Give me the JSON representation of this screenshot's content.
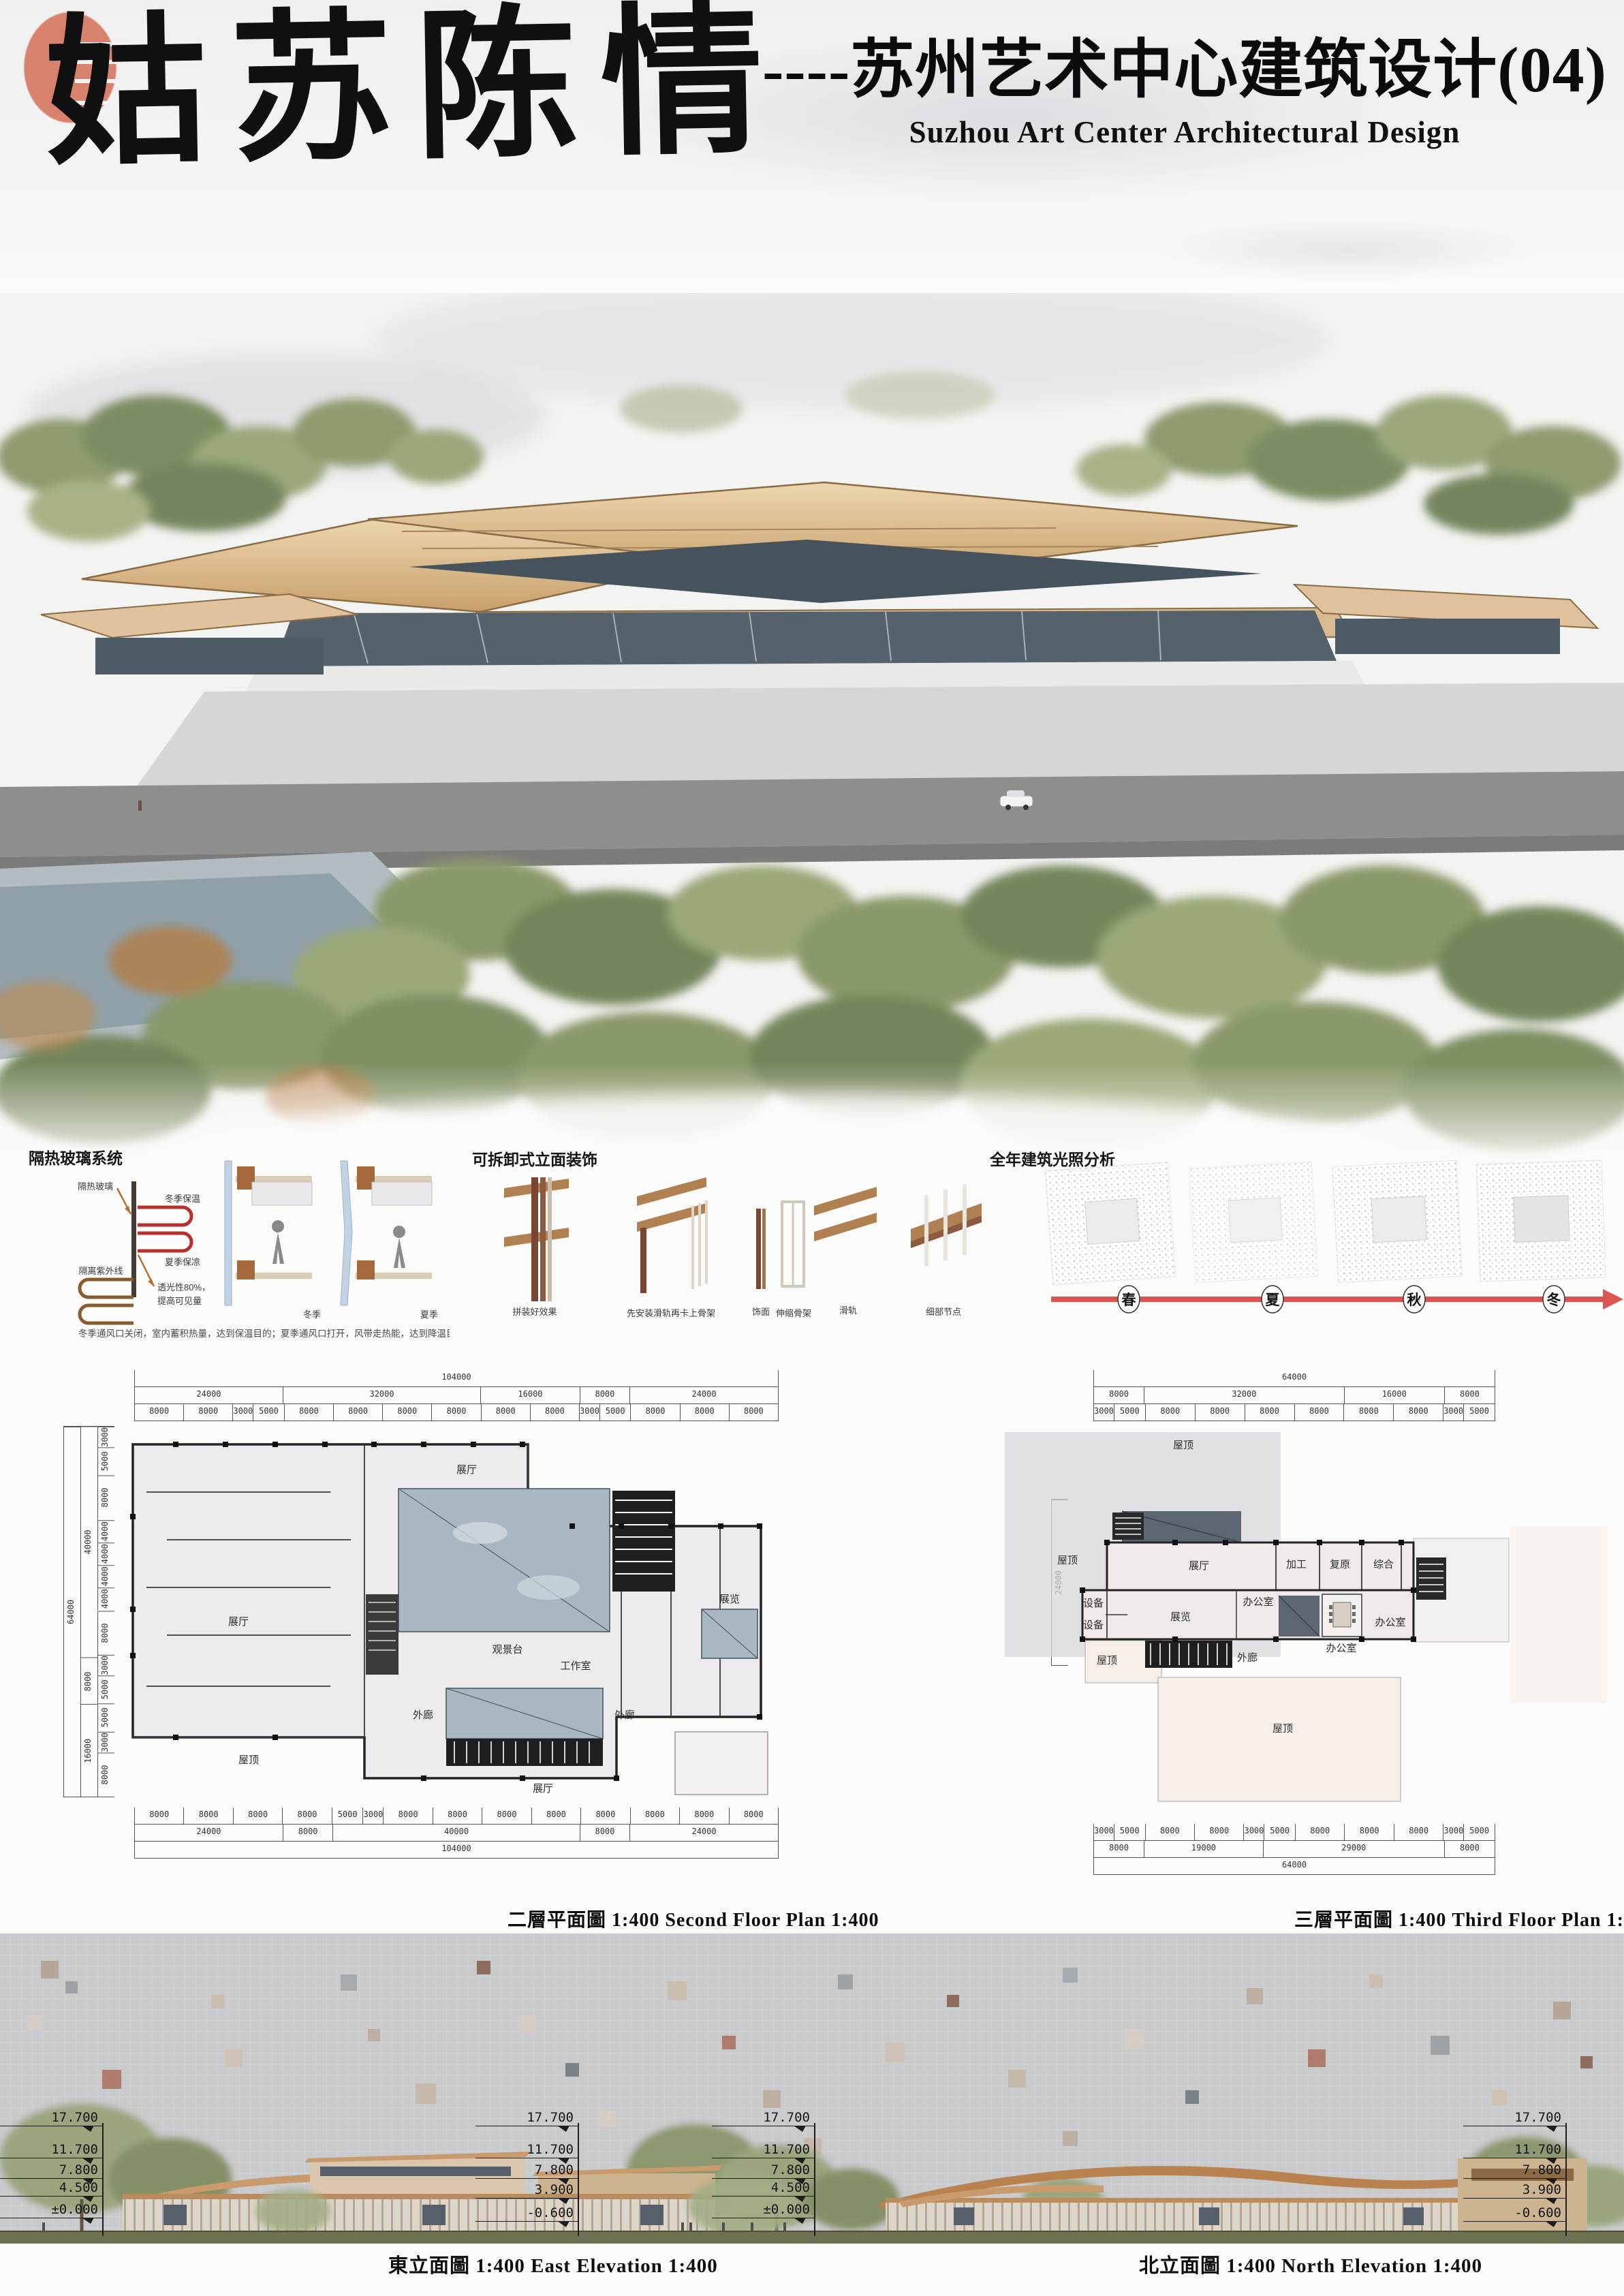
{
  "header": {
    "calligraphy_title": "姑苏陈情",
    "title_cn": "----苏州艺术中心建筑设计(04)",
    "title_en": "Suzhou Art Center Architectural Design"
  },
  "diagrams": {
    "glass": {
      "title": "隔热玻璃系统",
      "label_glass": "隔热玻璃",
      "label_winter_warm": "冬季保温",
      "label_uv": "隔离紫外线",
      "label_summer_cool": "夏季保凉",
      "label_translucency_1": "透光性80%，",
      "label_translucency_2": "提高可见量",
      "label_winter": "冬季",
      "label_summer": "夏季",
      "caption": "冬季通风口关闭，室内蓄积热量，达到保温目的；夏季通风口打开，风带走热能，达到降温目的"
    },
    "facade": {
      "title": "可拆卸式立面装饰",
      "labels": [
        "拼装好效果",
        "先安装滑轨再卡上骨架",
        "饰面",
        "伸缩骨架",
        "滑轨",
        "细部节点"
      ]
    },
    "sunlight": {
      "title": "全年建筑光照分析",
      "seasons": [
        "春",
        "夏",
        "秋",
        "冬"
      ],
      "arrow_color": "#dd5550"
    }
  },
  "plans": {
    "second": {
      "caption": "二層平面圖 1:400 Second  Floor Plan 1:400",
      "rooms": {
        "hall_top": "展厅",
        "hall_left": "展厅",
        "hall_bottom": "展厅",
        "deck": "观景台",
        "corridor_l": "外廊",
        "corridor_r": "外廊",
        "studio": "工作室",
        "exhibit": "展览",
        "roof": "屋顶"
      },
      "dims_top": {
        "total": [
          {
            "len": 104000,
            "label": "104000"
          }
        ],
        "groups": [
          {
            "len": 24000,
            "label": "24000"
          },
          {
            "len": 32000,
            "label": "32000"
          },
          {
            "len": 16000,
            "label": "16000"
          },
          {
            "len": 8000,
            "label": "8000"
          },
          {
            "len": 24000,
            "label": "24000"
          }
        ],
        "details": [
          {
            "len": 8000,
            "label": "8000"
          },
          {
            "len": 8000,
            "label": "8000"
          },
          {
            "len": 3000,
            "label": "3000"
          },
          {
            "len": 5000,
            "label": "5000"
          },
          {
            "len": 8000,
            "label": "8000"
          },
          {
            "len": 8000,
            "label": "8000"
          },
          {
            "len": 8000,
            "label": "8000"
          },
          {
            "len": 8000,
            "label": "8000"
          },
          {
            "len": 8000,
            "label": "8000"
          },
          {
            "len": 8000,
            "label": "8000"
          },
          {
            "len": 3000,
            "label": "3000"
          },
          {
            "len": 5000,
            "label": "5000"
          },
          {
            "len": 8000,
            "label": "8000"
          },
          {
            "len": 8000,
            "label": "8000"
          },
          {
            "len": 8000,
            "label": "8000"
          }
        ]
      },
      "dims_bottom": {
        "details": [
          {
            "len": 8000,
            "label": "8000"
          },
          {
            "len": 8000,
            "label": "8000"
          },
          {
            "len": 8000,
            "label": "8000"
          },
          {
            "len": 8000,
            "label": "8000"
          },
          {
            "len": 5000,
            "label": "5000"
          },
          {
            "len": 3000,
            "label": "3000"
          },
          {
            "len": 8000,
            "label": "8000"
          },
          {
            "len": 8000,
            "label": "8000"
          },
          {
            "len": 8000,
            "label": "8000"
          },
          {
            "len": 8000,
            "label": "8000"
          },
          {
            "len": 8000,
            "label": "8000"
          },
          {
            "len": 8000,
            "label": "8000"
          },
          {
            "len": 8000,
            "label": "8000"
          },
          {
            "len": 8000,
            "label": "8000"
          }
        ],
        "groups": [
          {
            "len": 24000,
            "label": "24000"
          },
          {
            "len": 8000,
            "label": "8000"
          },
          {
            "len": 40000,
            "label": "40000"
          },
          {
            "len": 8000,
            "label": "8000"
          },
          {
            "len": 24000,
            "label": "24000"
          }
        ],
        "total": [
          {
            "len": 104000,
            "label": "104000"
          }
        ]
      },
      "dims_left": {
        "total": [
          {
            "len": 64000,
            "label": "64000"
          }
        ],
        "groups": [
          {
            "len": 40000,
            "label": "40000"
          },
          {
            "len": 8000,
            "label": "8000"
          },
          {
            "len": 16000,
            "label": "16000"
          }
        ],
        "details": [
          {
            "len": 3000,
            "label": "3000"
          },
          {
            "len": 5000,
            "label": "5000"
          },
          {
            "len": 8000,
            "label": "8000"
          },
          {
            "len": 4000,
            "label": "4000"
          },
          {
            "len": 4000,
            "label": "4000"
          },
          {
            "len": 4000,
            "label": "4000"
          },
          {
            "len": 4000,
            "label": "4000"
          },
          {
            "len": 8000,
            "label": "8000"
          },
          {
            "len": 3000,
            "label": "3000"
          },
          {
            "len": 5000,
            "label": "5000"
          },
          {
            "len": 5000,
            "label": "5000"
          },
          {
            "len": 3000,
            "label": "3000"
          },
          {
            "len": 8000,
            "label": "8000"
          }
        ]
      }
    },
    "third": {
      "caption": "三層平面圖 1:400 Third Floor Plan 1:400",
      "rooms": {
        "roof_big": "屋顶",
        "roof_top": "屋顶",
        "roof_bl": "屋顶",
        "roof_bottom": "屋顶",
        "hall": "展厅",
        "process": "加工",
        "restore": "复原",
        "general": "综合",
        "office1": "办公室",
        "office2": "办公室",
        "office3": "办公室",
        "equip1": "设备",
        "equip2": "设备",
        "exhibit": "展览",
        "corridor": "外廊"
      },
      "dims_top": {
        "total": [
          {
            "len": 64000,
            "label": "64000"
          }
        ],
        "groups": [
          {
            "len": 8000,
            "label": "8000"
          },
          {
            "len": 32000,
            "label": "32000"
          },
          {
            "len": 16000,
            "label": "16000"
          },
          {
            "len": 8000,
            "label": "8000"
          }
        ],
        "details": [
          {
            "len": 3000,
            "label": "3000"
          },
          {
            "len": 5000,
            "label": "5000"
          },
          {
            "len": 8000,
            "label": "8000"
          },
          {
            "len": 8000,
            "label": "8000"
          },
          {
            "len": 8000,
            "label": "8000"
          },
          {
            "len": 8000,
            "label": "8000"
          },
          {
            "len": 8000,
            "label": "8000"
          },
          {
            "len": 8000,
            "label": "8000"
          },
          {
            "len": 3000,
            "label": "3000"
          },
          {
            "len": 5000,
            "label": "5000"
          }
        ]
      },
      "dims_bottom": {
        "details": [
          {
            "len": 3000,
            "label": "3000"
          },
          {
            "len": 5000,
            "label": "5000"
          },
          {
            "len": 8000,
            "label": "8000"
          },
          {
            "len": 8000,
            "label": "8000"
          },
          {
            "len": 3000,
            "label": "3000"
          },
          {
            "len": 5000,
            "label": "5000"
          },
          {
            "len": 8000,
            "label": "8000"
          },
          {
            "len": 8000,
            "label": "8000"
          },
          {
            "len": 8000,
            "label": "8000"
          },
          {
            "len": 3000,
            "label": "3000"
          },
          {
            "len": 5000,
            "label": "5000"
          }
        ],
        "groups": [
          {
            "len": 8000,
            "label": "8000"
          },
          {
            "len": 19000,
            "label": "19000"
          },
          {
            "len": 29000,
            "label": "29000"
          },
          {
            "len": 8000,
            "label": "8000"
          }
        ],
        "total": [
          {
            "len": 64000,
            "label": "64000"
          }
        ]
      },
      "dims_left": {
        "total": [
          {
            "len": 24000,
            "label": "24000"
          }
        ]
      }
    }
  },
  "elevations": {
    "east": {
      "caption": "東立面圖 1:400 East Elevation 1:400",
      "levels_left": [
        "17.700",
        "11.700",
        "7.800",
        "4.500",
        "±0.000"
      ],
      "levels_right": [
        "17.700",
        "11.700",
        "7.800",
        "3.900",
        "-0.600"
      ]
    },
    "north": {
      "caption": "北立面圖 1:400 North Elevation 1:400",
      "levels_left": [
        "17.700",
        "11.700",
        "7.800",
        "4.500",
        "±0.000"
      ],
      "levels_right": [
        "17.700",
        "11.700",
        "7.800",
        "3.900",
        "-0.600"
      ]
    }
  }
}
